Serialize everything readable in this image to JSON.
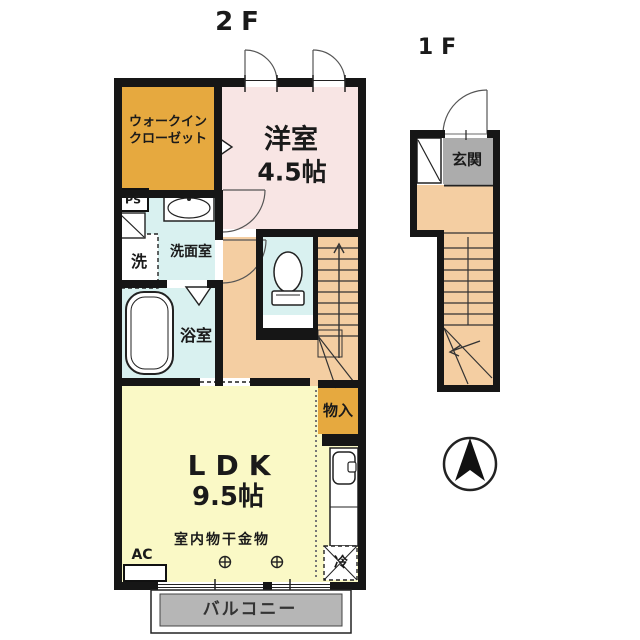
{
  "floors": {
    "f2": {
      "label": "2F"
    },
    "f1": {
      "label": "1F"
    }
  },
  "labels": {
    "wic_line1": "ウォークイン",
    "wic_line2": "クローゼット",
    "western_room_name": "洋室",
    "western_room_size": "4.5帖",
    "ps": "PS",
    "washroom": "洗面室",
    "washer": "洗",
    "bathroom": "浴室",
    "storage": "物入",
    "ldk_name": "LDK",
    "ldk_size": "9.5帖",
    "laundry_hardware": "室内物干金物",
    "ac": "AC",
    "fridge": "冷",
    "balcony": "バルコニー",
    "entrance": "玄関"
  },
  "icons": {
    "compass": "north-arrow",
    "hanging_point": "crosshair-circle",
    "door_swings": "quarter-arc",
    "stairs_up_arrow": "arrow-up",
    "stairs_down_arrow": "arrow-left"
  },
  "colors": {
    "wall": "#161616",
    "closet_orange": "#E6A93F",
    "room_pink": "#F8E5E4",
    "water_cyan": "#D9F1F0",
    "hall_tan": "#F4CEA2",
    "ldk_yellow": "#FAF9C6",
    "entrance_gray": "#ACACAC",
    "balcony_gray": "#B6B6B6",
    "line": "#333333"
  }
}
